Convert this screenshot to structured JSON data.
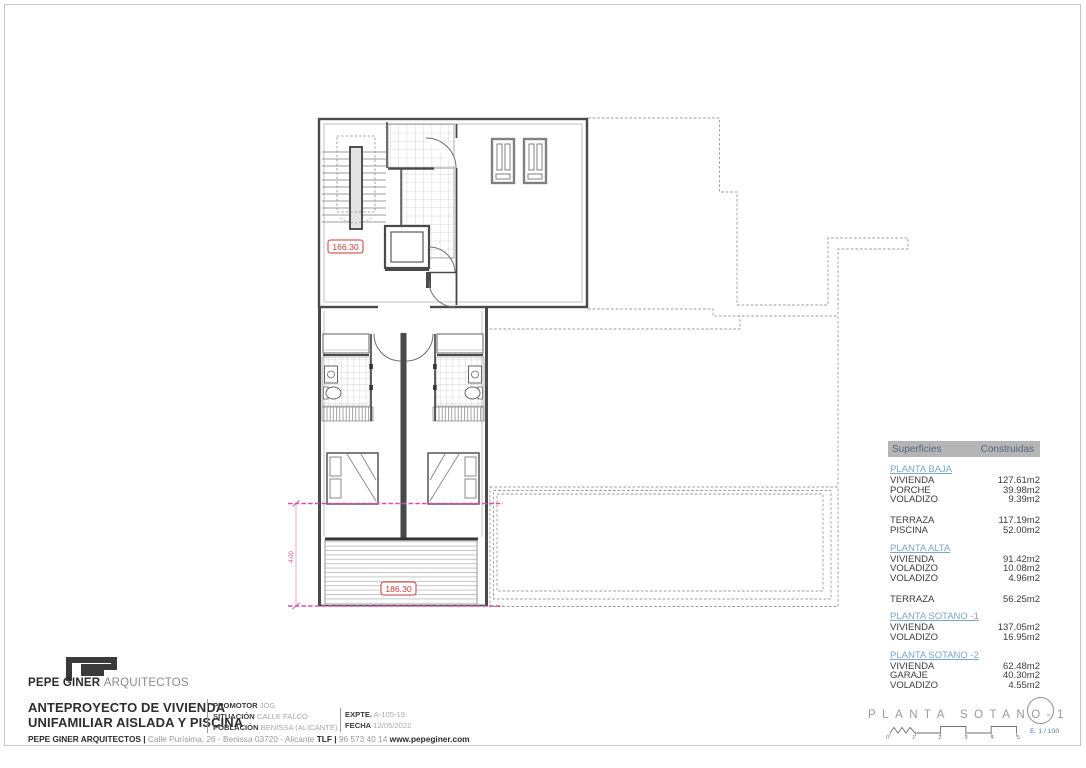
{
  "surface_table": {
    "header": {
      "col_left": "Superficies",
      "col_right": "Construidas"
    },
    "sections": [
      {
        "title": "PLANTA BAJA",
        "rows": [
          [
            "VIVIENDA",
            "127.61m2"
          ],
          [
            "PORCHE",
            "39.98m2"
          ],
          [
            "VOLADIZO",
            "9.39m2"
          ]
        ]
      },
      {
        "title": "",
        "rows": [
          [
            "TERRAZA",
            "117.19m2"
          ],
          [
            "PISCINA",
            "52.00m2"
          ]
        ]
      },
      {
        "title": "PLANTA ALTA",
        "rows": [
          [
            "VIVIENDA",
            "91.42m2"
          ],
          [
            "VOLADIZO",
            "10.08m2"
          ],
          [
            "VOLADIZO",
            "4.96m2"
          ]
        ]
      },
      {
        "title": "",
        "rows": [
          [
            "TERRAZA",
            "56.25m2"
          ]
        ]
      },
      {
        "title": "PLANTA SOTANO -1",
        "rows": [
          [
            "VIVIENDA",
            "137.05m2"
          ],
          [
            "VOLADIZO",
            "16.95m2"
          ]
        ]
      },
      {
        "title": "PLANTA SOTANO -2",
        "rows": [
          [
            "VIVIENDA",
            "62.48m2"
          ],
          [
            "GARAJE",
            "40.30m2"
          ],
          [
            "VOLADIZO",
            "4.55m2"
          ]
        ]
      }
    ]
  },
  "plan": {
    "level_upper": "166.30",
    "level_lower": "186.30",
    "dimension": "4.00"
  },
  "stamp": {
    "title": "PLANTA SOTANO-1",
    "scale_label": "E: 1 / 100",
    "scale_numbers": [
      "0",
      "1",
      "2",
      "3",
      "4",
      "5"
    ]
  },
  "title_block": {
    "firm_bold": "PEPE GINER",
    "firm_light": "ARQUITECTOS",
    "project_line1": "ANTEPROYECTO DE VIVIENDA",
    "project_line2": "UNIFAMILIAR AISLADA Y PISCINA",
    "project_fields": [
      {
        "label": "PROMOTOR",
        "value": "JOG"
      },
      {
        "label": "SITUACIÓN",
        "value": "CALLE FALCÓ"
      },
      {
        "label": "POBLACIÓN",
        "value": "BENISSA (ALICANTE)"
      }
    ],
    "expedient_fields": [
      {
        "label": "EXPTE.",
        "value": "A-105-19"
      },
      {
        "label": "FECHA",
        "value": "12/05/2022"
      }
    ],
    "contact": {
      "firm": "PEPE GINER ARQUITECTOS |",
      "address": "Calle Purísima, 26 - Benissa 03720 - Alicante",
      "tlf_label": "TLF |",
      "phone": "96 573 40 14",
      "web": "www.pepeginer.com"
    }
  },
  "colors": {
    "accent_blue": "#7ba7c9",
    "table_header_bg": "#b5b5b5",
    "table_header_text": "#56657c",
    "level_red": "#c53b35",
    "projection_magenta": "#d6519f",
    "dashed_gray": "#9a9a9a",
    "wall_gray": "#4a4a4a",
    "scale_blue": "#4a7ab5"
  }
}
